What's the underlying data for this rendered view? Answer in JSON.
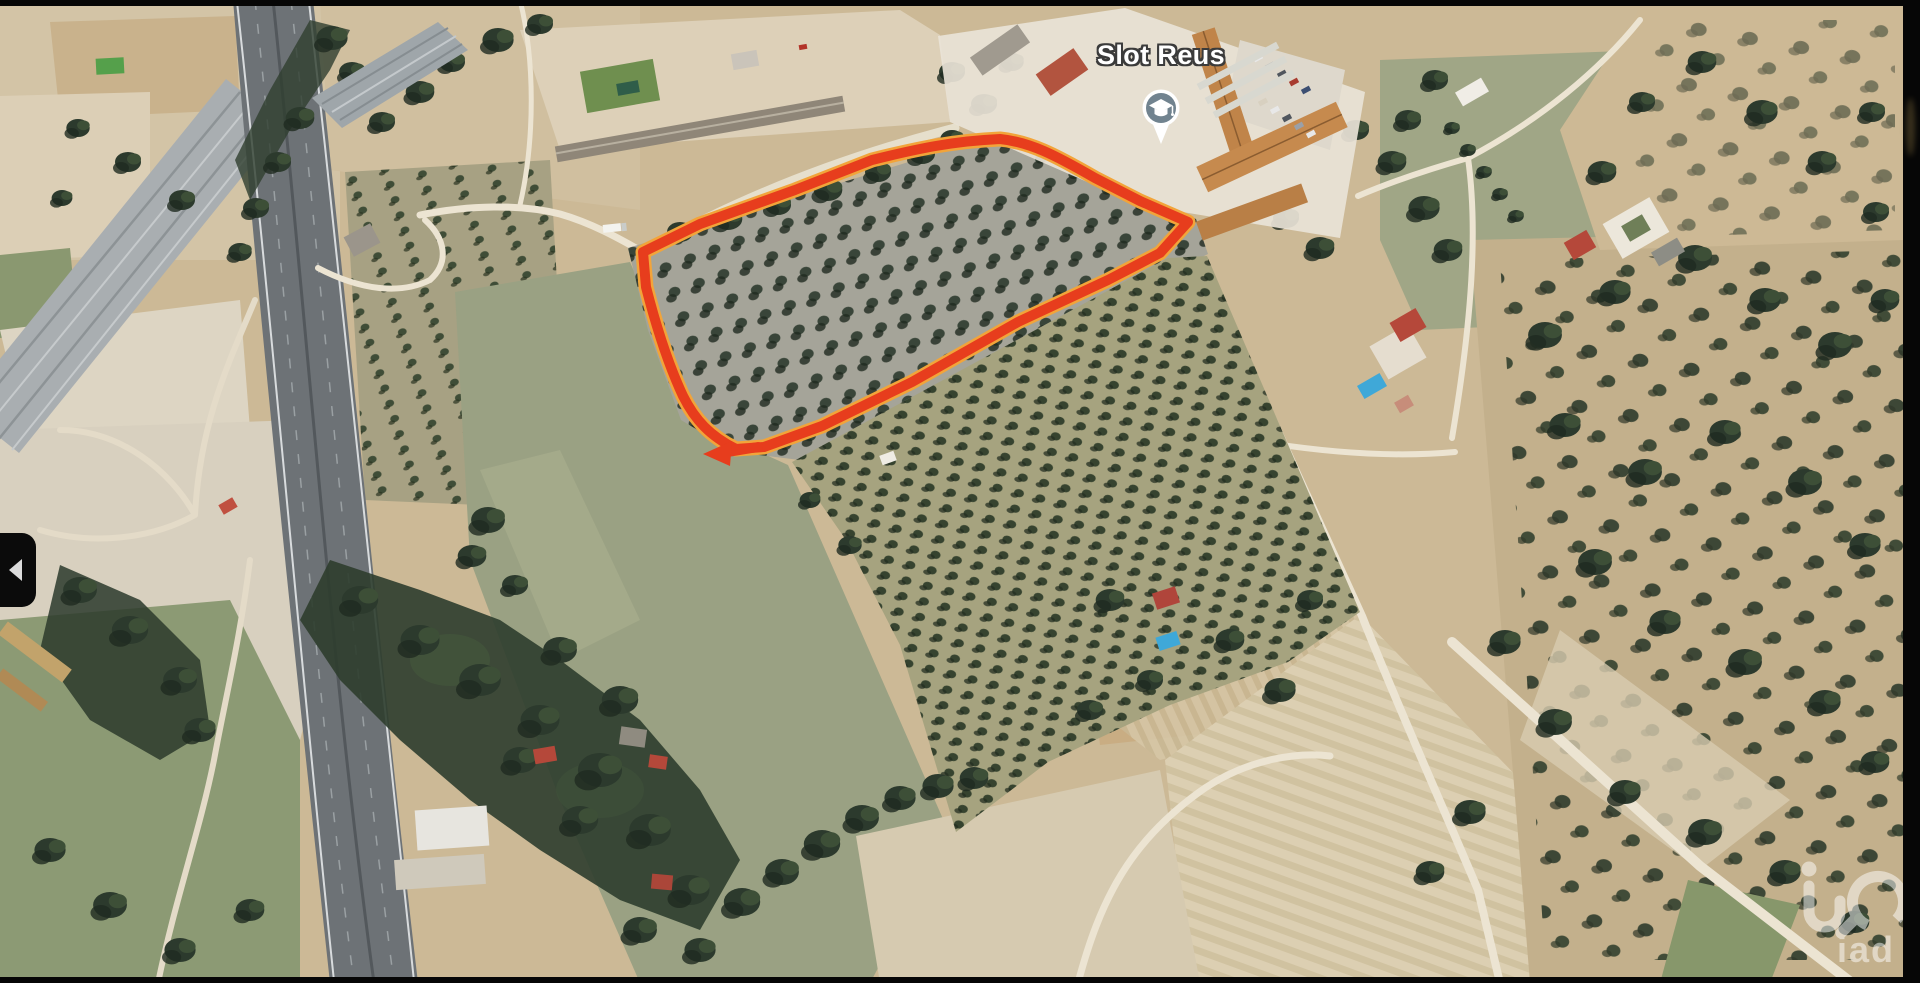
{
  "screen": {
    "width": 1920,
    "height": 983
  },
  "map": {
    "view": "satellite",
    "place_label": {
      "text": "Slot Reus",
      "marker_icon": "school-pin-icon"
    },
    "parcel_outline": {
      "stroke_color": "#e73d1d",
      "underlay_color": "#f2a43a",
      "shape": "hand-drawn closed loop around olive grove with arrow tail at south-west corner"
    }
  },
  "watermark": {
    "text": "iad",
    "logo": "iad-monogram-logo",
    "color": "#ffffff",
    "opacity": 0.5
  },
  "controls": {
    "collapse_panel_button": {
      "icon": "chevron-left-icon"
    }
  },
  "colors": {
    "outline_red": "#e73d1d",
    "outline_yellow": "#f2a43a",
    "marker_blue": "#71838f",
    "label_text": "#ffffff",
    "label_outline": "#3b3b3b",
    "letterbox": "#060606"
  }
}
